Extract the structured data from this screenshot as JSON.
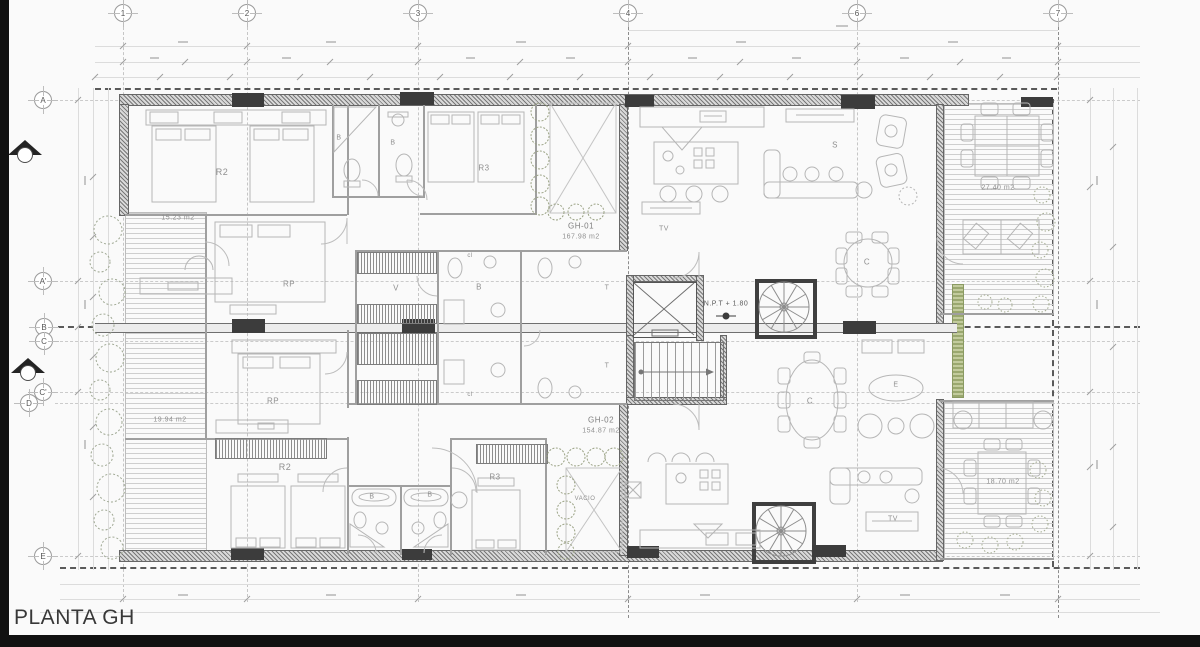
{
  "title": {
    "label": "PLANTA GH"
  },
  "grid": {
    "columns": [
      {
        "label": "1"
      },
      {
        "label": "2"
      },
      {
        "label": "3"
      },
      {
        "label": "4"
      },
      {
        "label": "6"
      },
      {
        "label": "7"
      }
    ],
    "rows": [
      {
        "label": "A"
      },
      {
        "label": "A'"
      },
      {
        "label": "B"
      },
      {
        "label": "C"
      },
      {
        "label": "C'"
      },
      {
        "label": "D"
      },
      {
        "label": "E"
      }
    ]
  },
  "units": {
    "gh01": {
      "code": "GH-01",
      "area": "167.98 m2"
    },
    "gh02": {
      "code": "GH-02",
      "area": "154.87 m2"
    }
  },
  "annotations": {
    "npt_level": "N.P.T + 1.80",
    "void_label": "VACIO"
  },
  "rooms": {
    "r2_top": "R2",
    "bath_top_1": "B",
    "bath_top_2": "B",
    "r3_top": "R3",
    "rp_top": "RP",
    "closet_v": "V",
    "bath_mid": "B",
    "closet_top": "cl",
    "closet_bottom": "cl",
    "toilet_top": "T",
    "toilet_bottom": "T",
    "tv_top": "TV",
    "living_s": "S",
    "dining_top": "C",
    "rp_bottom": "RP",
    "r2_bottom": "R2",
    "bath_bottom_1": "B",
    "bath_bottom_2": "B",
    "r3_bottom": "R3",
    "dining_bottom": "C",
    "study_e": "E",
    "tv_bottom": "TV"
  },
  "terraces": {
    "top_left": "15.23 m2",
    "bottom_left": "19.94 m2",
    "top_right": "27.40 m2",
    "bottom_right": "18.70 m2"
  },
  "colors": {
    "wall": "#4f4f4f",
    "line_light": "#b6b6b6",
    "label": "#8f8f8f",
    "vegetation": "#9aa86f",
    "frame": "#111111",
    "title_text": "#383838"
  }
}
